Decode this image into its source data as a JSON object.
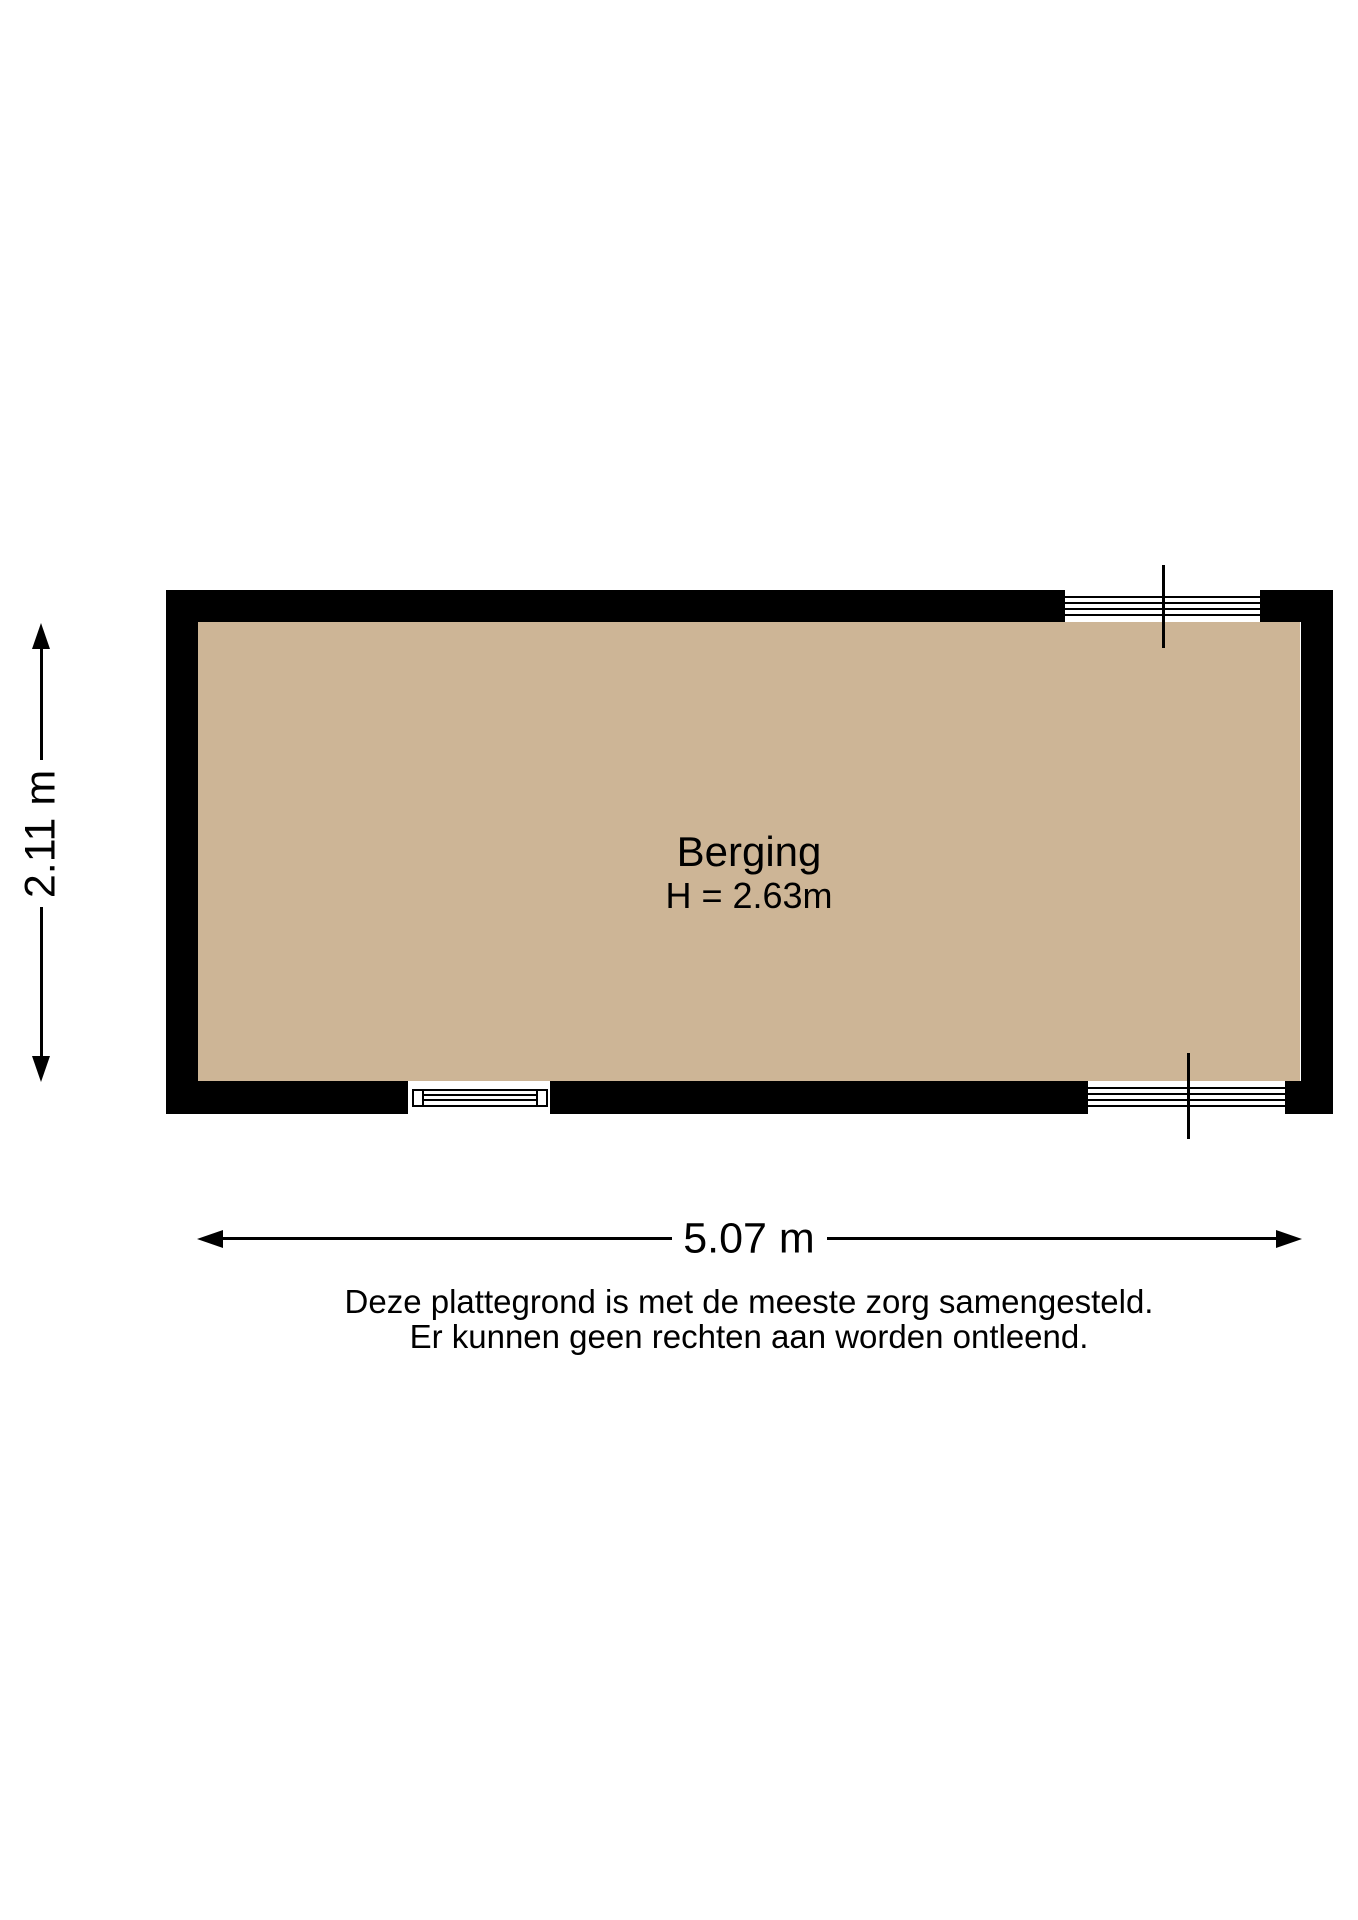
{
  "floorplan": {
    "room": {
      "name": "Berging",
      "ceiling_height": "H = 2.63m"
    },
    "dimensions": {
      "width": "5.07 m",
      "depth": "2.11 m"
    },
    "disclaimer": [
      "Deze plattegrond is met de meeste zorg samengesteld.",
      "Er kunnen geen rechten aan worden ontleend."
    ],
    "colors": {
      "floor": "#CDB596",
      "wall": "#000000",
      "background": "#FFFFFF"
    }
  }
}
